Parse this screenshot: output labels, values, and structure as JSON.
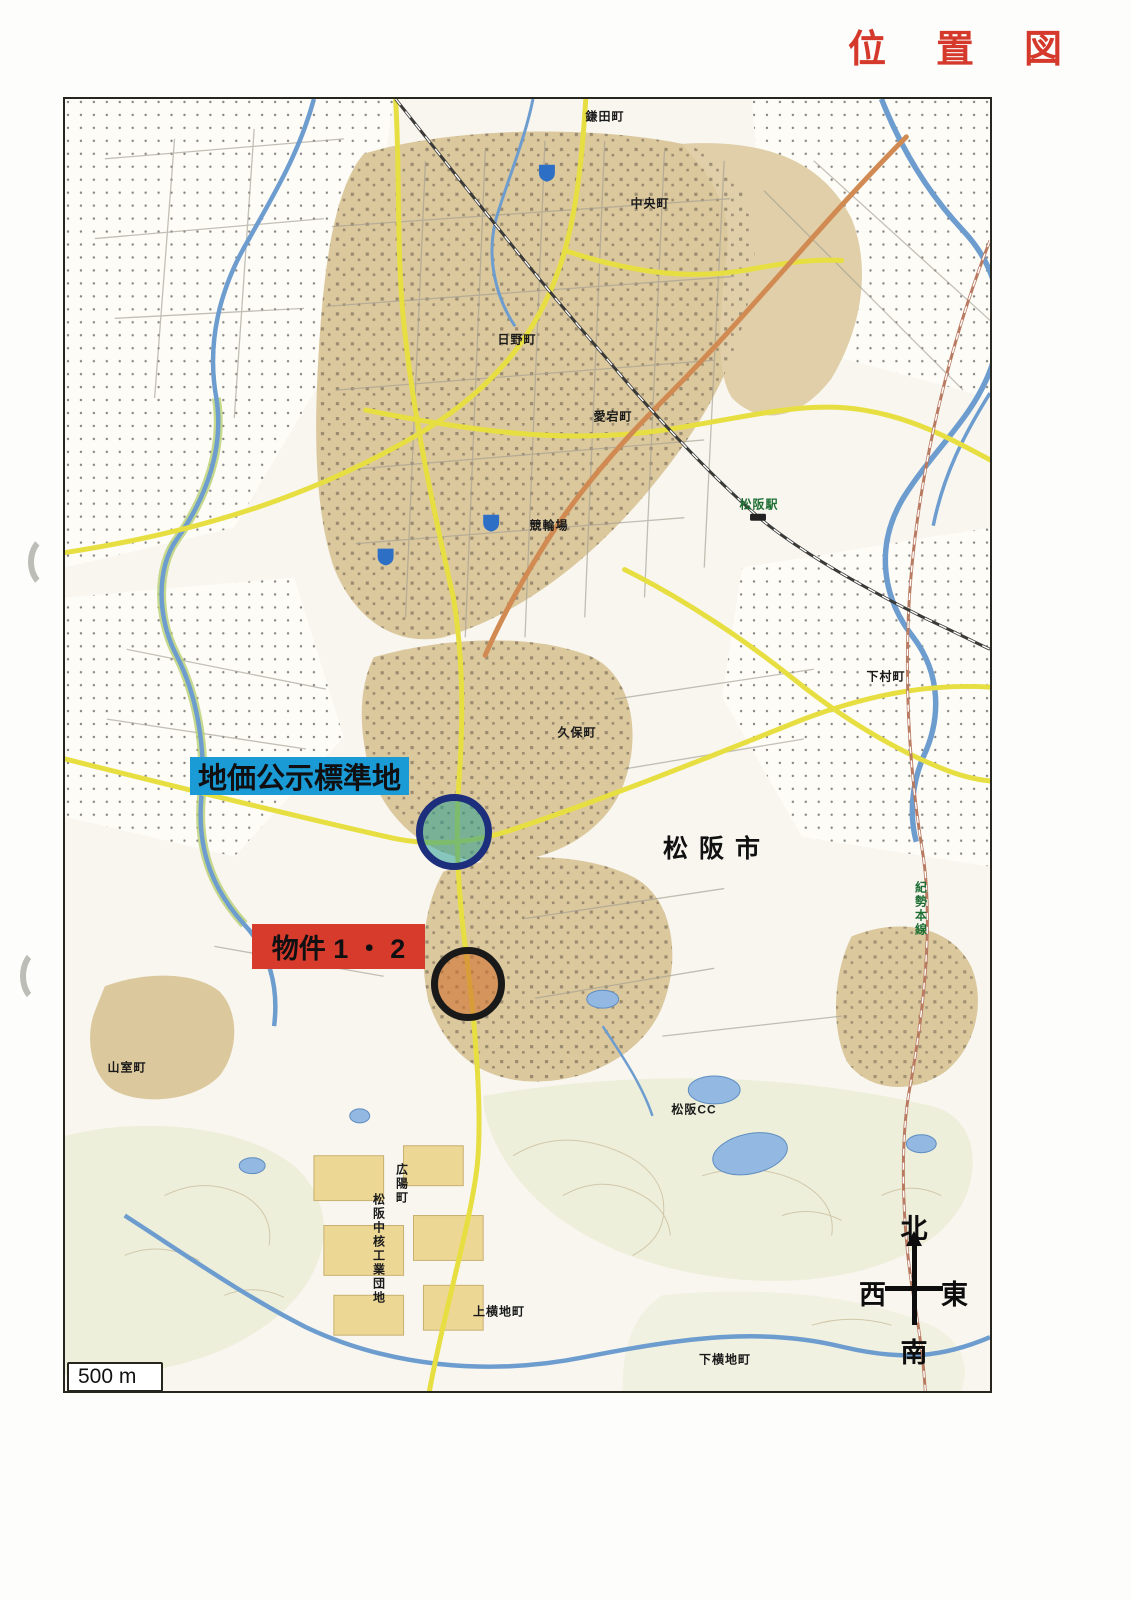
{
  "page": {
    "title": "位置図"
  },
  "theme": {
    "title_red": "#d4392b",
    "label_blue": "#1a9bd6",
    "label_red": "#d63b2c",
    "ring_navy": "#1c2e7c",
    "teal_fill": "rgba(40,158,146,0.55)",
    "ring_black": "#191919",
    "orange_fill": "rgba(206,116,52,0.62)",
    "paper": "#f8f6ef",
    "map_border": "#26261f"
  },
  "map": {
    "city_label": "松阪市",
    "standard_site_label": "地価公示標準地",
    "property_label": "物件 1 ・ 2",
    "scale_label": "500 m",
    "compass": {
      "north": "北",
      "south": "南",
      "east": "東",
      "west": "西"
    },
    "places": [
      {
        "label": "鎌田町"
      },
      {
        "label": "中央町"
      },
      {
        "label": "日野町"
      },
      {
        "label": "愛宕町"
      },
      {
        "label": "競輪場"
      },
      {
        "label": "松阪駅"
      },
      {
        "label": "下村町"
      },
      {
        "label": "久保町"
      },
      {
        "label": "紀勢本線"
      },
      {
        "label": "山室町"
      },
      {
        "label": "松阪CC"
      },
      {
        "label": "広陽町"
      },
      {
        "label": "松阪中核工業団地"
      },
      {
        "label": "上横地町"
      },
      {
        "label": "下横地町"
      }
    ]
  }
}
